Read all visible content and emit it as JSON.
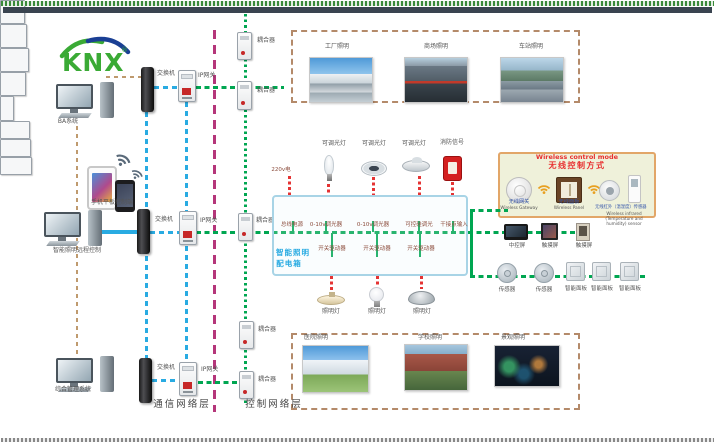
{
  "brand": {
    "logo_text": "KNX",
    "reg_mark": "®"
  },
  "left_column": {
    "computers": [
      {
        "label": "BA系统"
      },
      {
        "label": "智能照明远程控制"
      },
      {
        "label": "综合管理系统"
      }
    ],
    "mobile_label": "手机平板控制端"
  },
  "network": {
    "switch_labels": [
      "交换机",
      "交换机",
      "交换机"
    ],
    "gateway_labels": [
      "IP网关",
      "IP网关",
      "IP网关"
    ],
    "coupler_labels": [
      "耦合器",
      "耦合器",
      "耦合器",
      "耦合器",
      "耦合器"
    ],
    "layer_labels": {
      "communication": "通信网络层",
      "control": "控制网络层"
    }
  },
  "scenes_top": [
    {
      "label": "工厂照明"
    },
    {
      "label": "商场照明"
    },
    {
      "label": "车站照明"
    }
  ],
  "scenes_bottom": [
    {
      "label": "医院照明"
    },
    {
      "label": "学校照明"
    },
    {
      "label": "景观照明"
    }
  ],
  "cabinet": {
    "title_line1": "智能照明",
    "title_line2": "配电箱",
    "mains_label": "220v电",
    "load_labels": [
      "可调光灯",
      "可调光灯",
      "可调光灯",
      "消防信号"
    ],
    "module_labels": [
      "总线电源",
      "0-10v调光器",
      "0-10v调光器",
      "可控硅调光",
      "干接点输入"
    ],
    "actuator_labels": [
      "开关驱动器",
      "开关驱动器",
      "开关驱动器"
    ],
    "lamp_labels": [
      "照明灯",
      "照明灯",
      "照明灯"
    ]
  },
  "wireless": {
    "title_en": "Wireless control mode",
    "title_cn": "无线控制方式",
    "devices": [
      {
        "cn": "无线网关",
        "en": "Wireless Gateway"
      },
      {
        "cn": "无线面板",
        "en": "Wireless Panel"
      },
      {
        "cn": "无线红外（温湿度）传感器",
        "en": "Wireless infrared (Temperature and humidity) sensor"
      }
    ]
  },
  "right_column": {
    "screen_labels": [
      "中控屏",
      "触摸屏",
      "触摸屏"
    ],
    "device_labels": [
      "传感器",
      "传感器",
      "智能面板",
      "智能面板",
      "智能面板"
    ]
  },
  "colors": {
    "bus_green": "#00a651",
    "lan_blue": "#29abe2",
    "layer_divider_purple": "#b5367a",
    "system_tan": "#bf9a6e",
    "wire_red": "#e53333",
    "cabinet_border": "#a8d4e6",
    "cabinet_title": "#29abe2",
    "wireless_bg": "#eff1da",
    "wireless_border": "#e2a668",
    "wireless_title": "#e83030",
    "logo_green": "#3aaa35",
    "logo_blue": "#1a3f94"
  }
}
